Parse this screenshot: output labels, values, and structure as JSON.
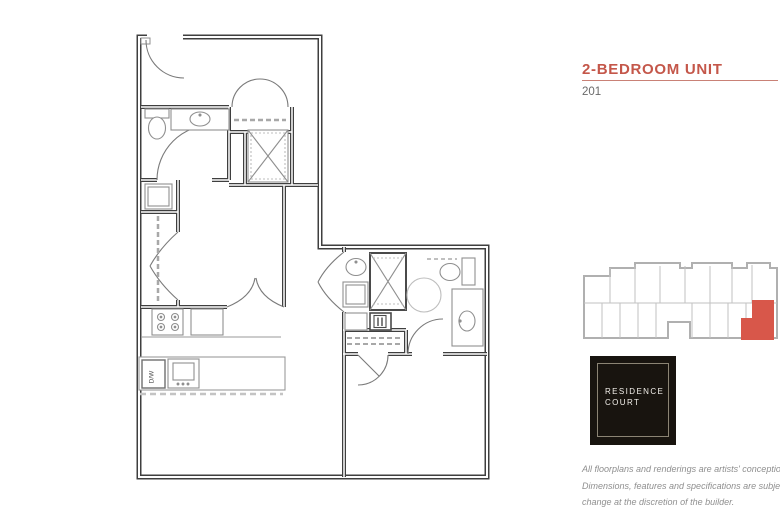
{
  "header": {
    "title": "2-BEDROOM UNIT",
    "unit_number": "201",
    "accent_color": "#C4574A",
    "rule_color": "#C98176"
  },
  "floorplan": {
    "labels": {
      "dishwasher": "D/W"
    },
    "wall_color": "#3F3F3F",
    "fixture_color": "#8F8F8F"
  },
  "keyplan": {
    "outline_color": "#B0B0B0",
    "highlight_color": "#D8574A"
  },
  "logo": {
    "line1": "RESIDENCE",
    "line2": "COURT",
    "background_color": "#18140F",
    "text_color": "#F2EFEA"
  },
  "disclaimer": {
    "lines": [
      "All floorplans and renderings are artists' conception.",
      "Dimensions, features and specifications are subject to",
      "change at the discretion of the builder."
    ]
  }
}
